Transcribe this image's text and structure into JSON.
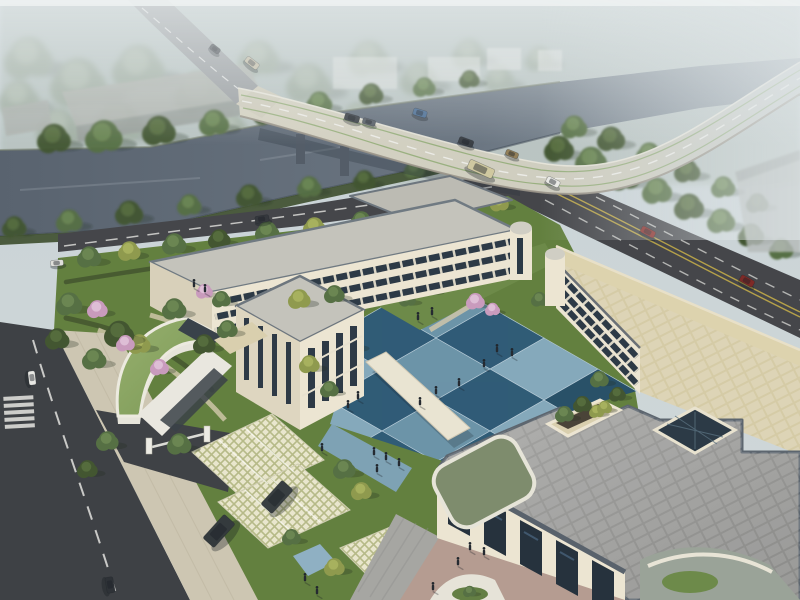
{
  "meta": {
    "title": "Aerial architectural rendering of a courtyard building complex with river bridge",
    "width": 800,
    "height": 600
  },
  "palette": {
    "sky_top": "#c8d2d8",
    "sky_low": "#cfd7d8",
    "mist": "#e4eaec",
    "river": "#59636f",
    "river_far": "#8b97a0",
    "bridge_deck": "#d5d2c2",
    "road_dark": "#45464a",
    "road_left": "#474a4e",
    "road_upper": "#9b9fa2",
    "marking_white": "#e6e6e2",
    "marking_yellow": "#c8b049",
    "lawn": "#63803f",
    "lawn_light": "#6d8a49",
    "hedge": "#43552f",
    "wall_cream": "#ece5d2",
    "wall_shade": "#d8d0ba",
    "window_dark": "#2d3a46",
    "roof_gray": "#c4c3bb",
    "roof_pave": "#9a9a98",
    "roof_tan": "#d5cba6",
    "green_roof": "#8aa565",
    "court_light": "#87abc2",
    "court_light2": "#6d95ae",
    "court_dark": "#2e5a7a",
    "court_dark2": "#264e6b",
    "lattice": "#e9e6cd",
    "plaza": "#a6a6a2",
    "plaza_pink": "#b59c91",
    "people": "#252a31"
  },
  "tree_colors": {
    "dark": [
      "#435631",
      "#587040"
    ],
    "mid": [
      "#567044",
      "#6e8a55"
    ],
    "light": [
      "#6f8a50",
      "#87a263"
    ],
    "yellow": [
      "#8f9a4e",
      "#abb562"
    ],
    "pale": [
      "#8a9a84",
      "#a3b29b"
    ],
    "pink": [
      "#c99bbd",
      "#e2c4da"
    ]
  },
  "courtyard": {
    "origin": [
      436,
      276
    ],
    "u": [
      54,
      31
    ],
    "v": [
      -54,
      31
    ],
    "cols": 4,
    "rows": 4
  },
  "trees": [
    {
      "g": "far",
      "x": 30,
      "y": 60,
      "r": 26,
      "k": "pale"
    },
    {
      "g": "far",
      "x": 80,
      "y": 85,
      "r": 30,
      "k": "pale"
    },
    {
      "g": "far",
      "x": 140,
      "y": 70,
      "r": 28,
      "k": "pale"
    },
    {
      "g": "far",
      "x": 200,
      "y": 95,
      "r": 26,
      "k": "pale"
    },
    {
      "g": "far",
      "x": 60,
      "y": 130,
      "r": 24,
      "k": "pale"
    },
    {
      "g": "far",
      "x": 120,
      "y": 125,
      "r": 26,
      "k": "pale"
    },
    {
      "g": "far",
      "x": 260,
      "y": 60,
      "r": 22,
      "k": "pale"
    },
    {
      "g": "far",
      "x": 310,
      "y": 85,
      "r": 24,
      "k": "pale"
    },
    {
      "g": "far",
      "x": 370,
      "y": 60,
      "r": 22,
      "k": "pale"
    },
    {
      "g": "far",
      "x": 420,
      "y": 80,
      "r": 20,
      "k": "pale"
    },
    {
      "g": "far",
      "x": 470,
      "y": 55,
      "r": 18,
      "k": "pale"
    },
    {
      "g": "far",
      "x": 300,
      "y": 130,
      "r": 22,
      "k": "pale"
    },
    {
      "g": "far",
      "x": 360,
      "y": 120,
      "r": 20,
      "k": "pale"
    },
    {
      "g": "far",
      "x": 20,
      "y": 100,
      "r": 22,
      "k": "pale"
    },
    {
      "g": "far",
      "x": 230,
      "y": 130,
      "r": 20,
      "k": "pale"
    },
    {
      "g": "far",
      "x": 500,
      "y": 80,
      "r": 16,
      "k": "pale"
    },
    {
      "g": "far",
      "x": 540,
      "y": 60,
      "r": 15,
      "k": "pale"
    },
    {
      "g": "bank",
      "x": 55,
      "y": 140,
      "r": 18,
      "k": "dark"
    },
    {
      "g": "bank",
      "x": 105,
      "y": 138,
      "r": 20,
      "k": "mid"
    },
    {
      "g": "bank",
      "x": 160,
      "y": 132,
      "r": 18,
      "k": "dark"
    },
    {
      "g": "bank",
      "x": 215,
      "y": 124,
      "r": 16,
      "k": "mid"
    },
    {
      "g": "bank",
      "x": 268,
      "y": 114,
      "r": 15,
      "k": "dark"
    },
    {
      "g": "bank",
      "x": 320,
      "y": 104,
      "r": 14,
      "k": "mid"
    },
    {
      "g": "bank",
      "x": 372,
      "y": 95,
      "r": 13,
      "k": "dark"
    },
    {
      "g": "bank",
      "x": 425,
      "y": 88,
      "r": 12,
      "k": "mid"
    },
    {
      "g": "bank",
      "x": 470,
      "y": 80,
      "r": 11,
      "k": "dark"
    },
    {
      "g": "bank",
      "x": 15,
      "y": 228,
      "r": 13,
      "k": "dark"
    },
    {
      "g": "bank",
      "x": 70,
      "y": 222,
      "r": 14,
      "k": "mid"
    },
    {
      "g": "bank",
      "x": 130,
      "y": 214,
      "r": 15,
      "k": "dark"
    },
    {
      "g": "bank",
      "x": 190,
      "y": 206,
      "r": 13,
      "k": "mid"
    },
    {
      "g": "bank",
      "x": 250,
      "y": 197,
      "r": 14,
      "k": "dark"
    },
    {
      "g": "bank",
      "x": 310,
      "y": 188,
      "r": 13,
      "k": "mid"
    },
    {
      "g": "bank",
      "x": 365,
      "y": 181,
      "r": 12,
      "k": "dark"
    },
    {
      "g": "bank",
      "x": 415,
      "y": 170,
      "r": 11,
      "k": "mid"
    },
    {
      "g": "bank",
      "x": 462,
      "y": 159,
      "r": 11,
      "k": "dark"
    },
    {
      "g": "rforest",
      "x": 560,
      "y": 150,
      "r": 16,
      "k": "dark"
    },
    {
      "g": "rforest",
      "x": 592,
      "y": 162,
      "r": 17,
      "k": "mid"
    },
    {
      "g": "rforest",
      "x": 625,
      "y": 178,
      "r": 17,
      "k": "dark"
    },
    {
      "g": "rforest",
      "x": 658,
      "y": 192,
      "r": 16,
      "k": "mid"
    },
    {
      "g": "rforest",
      "x": 690,
      "y": 208,
      "r": 16,
      "k": "dark"
    },
    {
      "g": "rforest",
      "x": 722,
      "y": 222,
      "r": 15,
      "k": "mid"
    },
    {
      "g": "rforest",
      "x": 752,
      "y": 236,
      "r": 14,
      "k": "dark"
    },
    {
      "g": "rforest",
      "x": 782,
      "y": 250,
      "r": 13,
      "k": "mid"
    },
    {
      "g": "rforest",
      "x": 575,
      "y": 128,
      "r": 14,
      "k": "mid"
    },
    {
      "g": "rforest",
      "x": 612,
      "y": 140,
      "r": 15,
      "k": "dark"
    },
    {
      "g": "rforest",
      "x": 650,
      "y": 155,
      "r": 14,
      "k": "mid"
    },
    {
      "g": "rforest",
      "x": 688,
      "y": 172,
      "r": 14,
      "k": "dark"
    },
    {
      "g": "rforest",
      "x": 724,
      "y": 188,
      "r": 13,
      "k": "mid"
    },
    {
      "g": "rforest",
      "x": 758,
      "y": 204,
      "r": 12,
      "k": "dark"
    },
    {
      "g": "mid",
      "x": 90,
      "y": 258,
      "r": 13,
      "k": "mid"
    },
    {
      "g": "mid",
      "x": 130,
      "y": 252,
      "r": 12,
      "k": "yellow"
    },
    {
      "g": "mid",
      "x": 175,
      "y": 245,
      "r": 13,
      "k": "mid"
    },
    {
      "g": "mid",
      "x": 220,
      "y": 240,
      "r": 12,
      "k": "dark"
    },
    {
      "g": "mid",
      "x": 268,
      "y": 233,
      "r": 13,
      "k": "mid"
    },
    {
      "g": "mid",
      "x": 315,
      "y": 228,
      "r": 12,
      "k": "yellow"
    },
    {
      "g": "mid",
      "x": 362,
      "y": 222,
      "r": 12,
      "k": "mid"
    },
    {
      "g": "mid",
      "x": 410,
      "y": 216,
      "r": 11,
      "k": "dark"
    },
    {
      "g": "mid",
      "x": 458,
      "y": 210,
      "r": 11,
      "k": "mid"
    },
    {
      "g": "mid",
      "x": 500,
      "y": 204,
      "r": 10,
      "k": "yellow"
    },
    {
      "g": "court",
      "x": 408,
      "y": 300,
      "r": 9,
      "k": "mid"
    },
    {
      "g": "court",
      "x": 476,
      "y": 302,
      "r": 10,
      "k": "pink"
    },
    {
      "g": "court",
      "x": 493,
      "y": 310,
      "r": 8,
      "k": "pink"
    },
    {
      "g": "court",
      "x": 540,
      "y": 300,
      "r": 9,
      "k": "mid"
    },
    {
      "g": "court",
      "x": 352,
      "y": 345,
      "r": 11,
      "k": "yellow"
    },
    {
      "g": "court",
      "x": 330,
      "y": 372,
      "r": 11,
      "k": "mid"
    },
    {
      "g": "court",
      "x": 318,
      "y": 400,
      "r": 10,
      "k": "yellow"
    },
    {
      "g": "court",
      "x": 432,
      "y": 290,
      "r": 8,
      "k": "mid"
    },
    {
      "g": "garden",
      "x": 70,
      "y": 305,
      "r": 14,
      "k": "mid"
    },
    {
      "g": "garden",
      "x": 58,
      "y": 340,
      "r": 13,
      "k": "dark"
    },
    {
      "g": "garden",
      "x": 95,
      "y": 360,
      "r": 13,
      "k": "mid"
    },
    {
      "g": "garden",
      "x": 140,
      "y": 345,
      "r": 12,
      "k": "yellow"
    },
    {
      "g": "garden",
      "x": 175,
      "y": 310,
      "r": 13,
      "k": "mid"
    },
    {
      "g": "garden",
      "x": 205,
      "y": 345,
      "r": 12,
      "k": "dark"
    },
    {
      "g": "garden",
      "x": 228,
      "y": 330,
      "r": 11,
      "k": "mid"
    },
    {
      "g": "garden",
      "x": 300,
      "y": 300,
      "r": 12,
      "k": "yellow"
    },
    {
      "g": "garden",
      "x": 335,
      "y": 295,
      "r": 11,
      "k": "mid"
    },
    {
      "g": "garden",
      "x": 120,
      "y": 335,
      "r": 16,
      "k": "dark"
    },
    {
      "g": "garden",
      "x": 98,
      "y": 310,
      "r": 11,
      "k": "pink"
    },
    {
      "g": "garden",
      "x": 126,
      "y": 344,
      "r": 10,
      "k": "pink"
    },
    {
      "g": "garden",
      "x": 205,
      "y": 292,
      "r": 9,
      "k": "pink"
    },
    {
      "g": "garden",
      "x": 160,
      "y": 368,
      "r": 10,
      "k": "pink"
    },
    {
      "g": "garden",
      "x": 310,
      "y": 365,
      "r": 11,
      "k": "yellow"
    },
    {
      "g": "garden",
      "x": 330,
      "y": 390,
      "r": 10,
      "k": "mid"
    },
    {
      "g": "garden",
      "x": 222,
      "y": 300,
      "r": 10,
      "k": "mid"
    },
    {
      "g": "front",
      "x": 180,
      "y": 445,
      "r": 13,
      "k": "mid"
    },
    {
      "g": "front",
      "x": 108,
      "y": 442,
      "r": 12,
      "k": "mid"
    },
    {
      "g": "front",
      "x": 88,
      "y": 470,
      "r": 11,
      "k": "dark"
    },
    {
      "g": "front",
      "x": 345,
      "y": 470,
      "r": 12,
      "k": "mid"
    },
    {
      "g": "front",
      "x": 362,
      "y": 492,
      "r": 11,
      "k": "yellow"
    },
    {
      "g": "front",
      "x": 335,
      "y": 568,
      "r": 11,
      "k": "yellow"
    },
    {
      "g": "front",
      "x": 292,
      "y": 538,
      "r": 10,
      "k": "mid"
    },
    {
      "g": "front",
      "x": 565,
      "y": 415,
      "r": 10,
      "k": "mid"
    },
    {
      "g": "front",
      "x": 583,
      "y": 405,
      "r": 10,
      "k": "dark"
    },
    {
      "g": "front",
      "x": 597,
      "y": 412,
      "r": 8,
      "k": "yellow"
    },
    {
      "g": "front",
      "x": 600,
      "y": 380,
      "r": 10,
      "k": "mid"
    },
    {
      "g": "front",
      "x": 618,
      "y": 395,
      "r": 9,
      "k": "dark"
    },
    {
      "g": "front",
      "x": 605,
      "y": 408,
      "r": 8,
      "k": "yellow"
    },
    {
      "g": "front",
      "x": 470,
      "y": 592,
      "r": 7,
      "k": "mid"
    }
  ],
  "cars": [
    {
      "g": "bridge",
      "x": 352,
      "y": 118,
      "l": 15,
      "w": 7,
      "a": 16,
      "c": "#3d4248"
    },
    {
      "g": "bridge",
      "x": 369,
      "y": 122,
      "l": 13,
      "w": 6,
      "a": 16,
      "c": "#596068"
    },
    {
      "g": "bridge",
      "x": 420,
      "y": 113,
      "l": 14,
      "w": 7,
      "a": 17,
      "c": "#4d6f95"
    },
    {
      "g": "bridge",
      "x": 466,
      "y": 142,
      "l": 15,
      "w": 7,
      "a": 20,
      "c": "#3a3f45"
    },
    {
      "g": "bridge",
      "x": 512,
      "y": 154,
      "l": 13,
      "w": 6,
      "a": 22,
      "c": "#93805a"
    },
    {
      "g": "bridge",
      "x": 481,
      "y": 169,
      "l": 27,
      "w": 10,
      "a": 24,
      "c": "#cfc8a0"
    },
    {
      "g": "upper",
      "x": 215,
      "y": 49,
      "l": 11,
      "w": 6,
      "a": 38,
      "c": "#474b51"
    },
    {
      "g": "upper",
      "x": 252,
      "y": 63,
      "l": 15,
      "w": 7,
      "a": 38,
      "c": "#c2bba4"
    },
    {
      "g": "road",
      "x": 262,
      "y": 219,
      "l": 14,
      "w": 7,
      "a": -9,
      "c": "#35383d"
    },
    {
      "g": "road",
      "x": 553,
      "y": 182,
      "l": 14,
      "w": 7,
      "a": 27,
      "c": "#e9e9e5"
    },
    {
      "g": "road",
      "x": 648,
      "y": 232,
      "l": 15,
      "w": 7,
      "a": 28,
      "c": "#8a2f2b"
    },
    {
      "g": "road",
      "x": 747,
      "y": 281,
      "l": 15,
      "w": 7,
      "a": 29,
      "c": "#7e2a27"
    },
    {
      "g": "road",
      "x": 57,
      "y": 263,
      "l": 13,
      "w": 6,
      "a": -5,
      "c": "#dfdfdb"
    },
    {
      "g": "road",
      "x": 32,
      "y": 378,
      "l": 14,
      "w": 7,
      "a": 83,
      "c": "#e8e8e4"
    },
    {
      "g": "road",
      "x": 110,
      "y": 585,
      "l": 16,
      "w": 8,
      "a": 80,
      "c": "#2e3237"
    },
    {
      "g": "site",
      "x": 219,
      "y": 531,
      "l": 32,
      "w": 15,
      "a": -48,
      "c": "#343a3d"
    },
    {
      "g": "site",
      "x": 277,
      "y": 497,
      "l": 32,
      "w": 15,
      "a": -48,
      "c": "#383e41"
    }
  ],
  "people": [
    [
      497,
      349
    ],
    [
      512,
      353
    ],
    [
      484,
      364
    ],
    [
      459,
      383
    ],
    [
      436,
      391
    ],
    [
      420,
      402
    ],
    [
      358,
      396
    ],
    [
      348,
      405
    ],
    [
      374,
      452
    ],
    [
      386,
      457
    ],
    [
      399,
      463
    ],
    [
      377,
      469
    ],
    [
      322,
      448
    ],
    [
      470,
      547
    ],
    [
      484,
      552
    ],
    [
      458,
      562
    ],
    [
      433,
      587
    ],
    [
      305,
      578
    ],
    [
      317,
      591
    ],
    [
      194,
      284
    ],
    [
      205,
      289
    ],
    [
      418,
      317
    ],
    [
      432,
      312
    ]
  ]
}
